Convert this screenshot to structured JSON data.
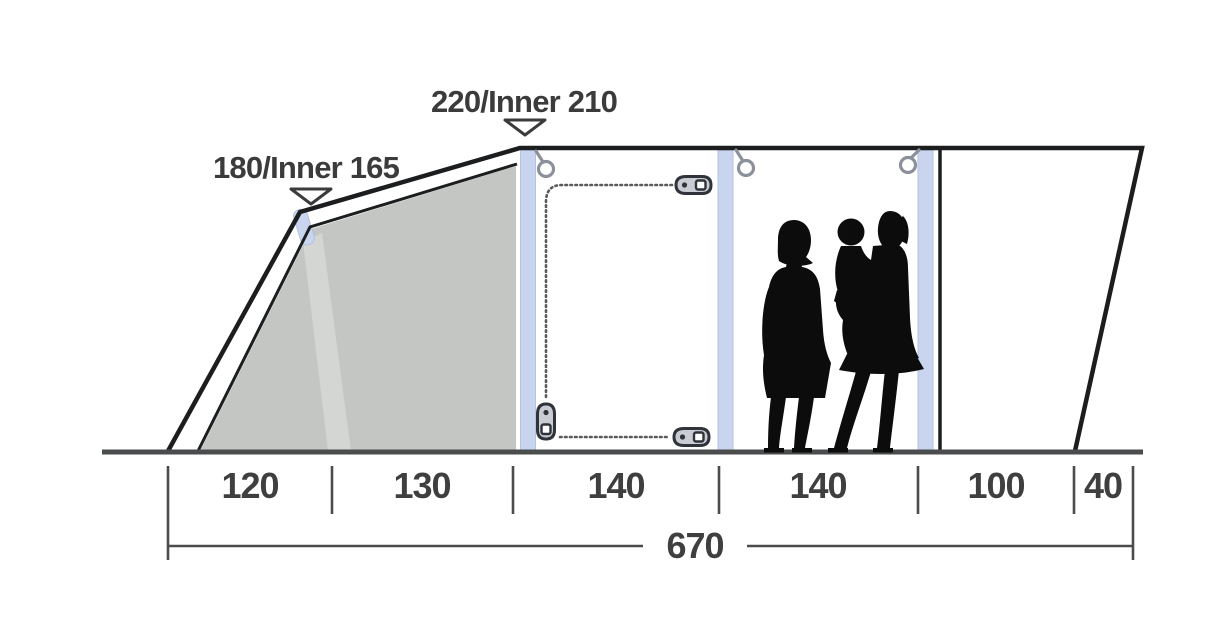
{
  "diagram": {
    "type": "tent-side-profile-dimension-diagram",
    "height_labels": [
      {
        "name": "front-height",
        "text": "180/Inner 165"
      },
      {
        "name": "peak-height",
        "text": "220/Inner 210"
      }
    ],
    "width_sections": [
      {
        "label": "120"
      },
      {
        "label": "130"
      },
      {
        "label": "140"
      },
      {
        "label": "140"
      },
      {
        "label": "100"
      },
      {
        "label": "40"
      }
    ],
    "total_width": {
      "label": "670"
    },
    "icons": {
      "height_marker": "triangle-down-marker",
      "roof_ring": "hanging-ring-icon",
      "zipper_pull": "zipper-slider-icon"
    },
    "figures": {
      "people": [
        "adult-silhouette",
        "adult-holding-child-silhouette"
      ]
    },
    "colors": {
      "outline": "#1b1d1f",
      "inner_panel": "#c3c6c2",
      "panel_highlight": "#d3d6d2",
      "air_pole": "#c9d5ee",
      "ground": "#4a4c4e",
      "dimension_text": "#3f3f3f",
      "silhouette": "#0c0c0c",
      "ring_gray": "#8b909b"
    }
  }
}
